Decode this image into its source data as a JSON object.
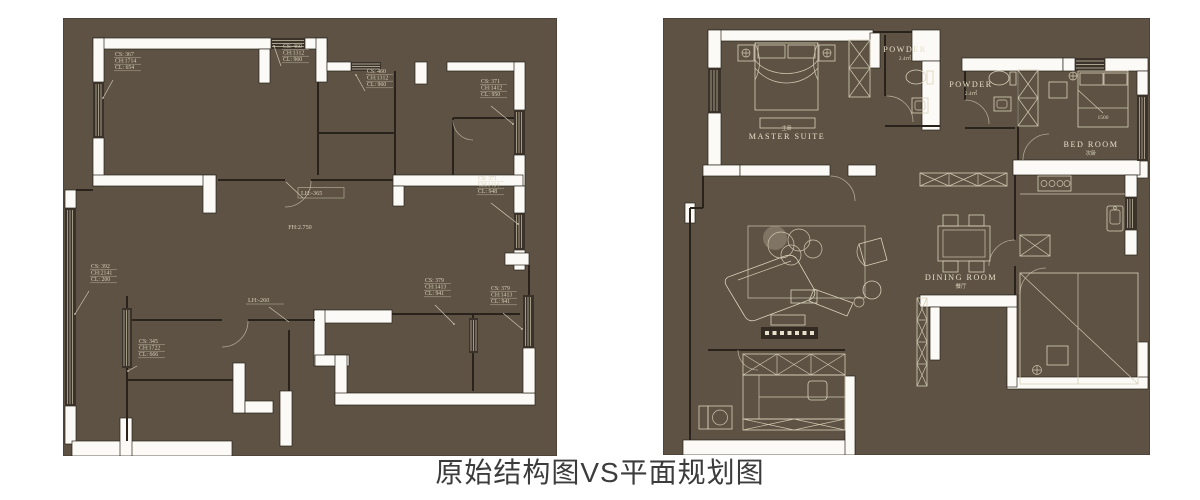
{
  "caption": "原始结构图VS平面规划图",
  "colors": {
    "page_bg": "#ffffff",
    "plan_bg": "#5d5244",
    "wall_white": "#fbfaf6",
    "dark_line": "#2a231b",
    "furniture_line": "#d9d1ba",
    "annotation_text": "#ded6c1",
    "caption_text": "#3c3c3c"
  },
  "left_plan": {
    "floor_height_label": "FH:2.750",
    "window_annotations": [
      {
        "lines": [
          "CS: 367",
          "CH:1714",
          "CL: 654"
        ],
        "x": 52,
        "y": 38,
        "leader": [
          50,
          62,
          40,
          80
        ]
      },
      {
        "lines": [
          "CS: 460",
          "CH:1312",
          "CL: 960"
        ],
        "x": 220,
        "y": 30,
        "leader": [
          218,
          48,
          211,
          28
        ]
      },
      {
        "lines": [
          "CS: 460",
          "CH:1312",
          "CL: 960"
        ],
        "x": 304,
        "y": 55,
        "leader": [
          302,
          73,
          293,
          57
        ]
      },
      {
        "lines": [
          "CS: 371",
          "CH:1412",
          "CL: 950"
        ],
        "x": 418,
        "y": 65,
        "leader": [
          428,
          88,
          450,
          106
        ]
      },
      {
        "lines": [
          "CS: 371",
          "CH:1414",
          "CL: 948"
        ],
        "x": 415,
        "y": 162,
        "leader": [
          428,
          185,
          455,
          206
        ]
      },
      {
        "lines": [
          "CS: 392",
          "CH:2141",
          "CL: 200"
        ],
        "x": 28,
        "y": 250,
        "leader": [
          26,
          273,
          12,
          296
        ]
      },
      {
        "lines": [
          "CS: 379",
          "CH:1413",
          "CL: 941"
        ],
        "x": 362,
        "y": 264,
        "leader": [
          372,
          287,
          391,
          306
        ]
      },
      {
        "lines": [
          "CS: 379",
          "CH:1413",
          "CL: 941"
        ],
        "x": 428,
        "y": 272,
        "leader": [
          440,
          295,
          459,
          311
        ]
      },
      {
        "lines": [
          "CS: 345",
          "CH:1722",
          "CL: 666"
        ],
        "x": 76,
        "y": 325,
        "leader": [
          74,
          348,
          65,
          353
        ]
      }
    ],
    "level_annotations": [
      {
        "text": "LH:-365",
        "x": 238,
        "y": 177,
        "boxed": true,
        "leader": [
          240,
          180,
          223,
          164
        ]
      },
      {
        "text": "LH:-260",
        "x": 185,
        "y": 284,
        "boxed": false,
        "leader": [
          206,
          289,
          226,
          304
        ]
      }
    ]
  },
  "right_plan": {
    "rooms": [
      {
        "name": "MASTER SUITE",
        "sub": "主卧",
        "x": 124,
        "y": 121,
        "sub_above": true
      },
      {
        "name": "POWDER",
        "sub": "2.4㎡",
        "x": 242,
        "y": 34,
        "sub_above": false
      },
      {
        "name": "POWDER",
        "sub": "2.4㎡",
        "x": 308,
        "y": 69,
        "sub_above": false
      },
      {
        "name": "BED ROOM",
        "sub": "次卧",
        "x": 428,
        "y": 129,
        "sub_above": false
      },
      {
        "name": "DINING ROOM",
        "sub": "餐厅",
        "x": 298,
        "y": 262,
        "sub_above": false
      }
    ],
    "bed_width_label": {
      "text": "1500",
      "x": 440,
      "y": 101
    }
  }
}
